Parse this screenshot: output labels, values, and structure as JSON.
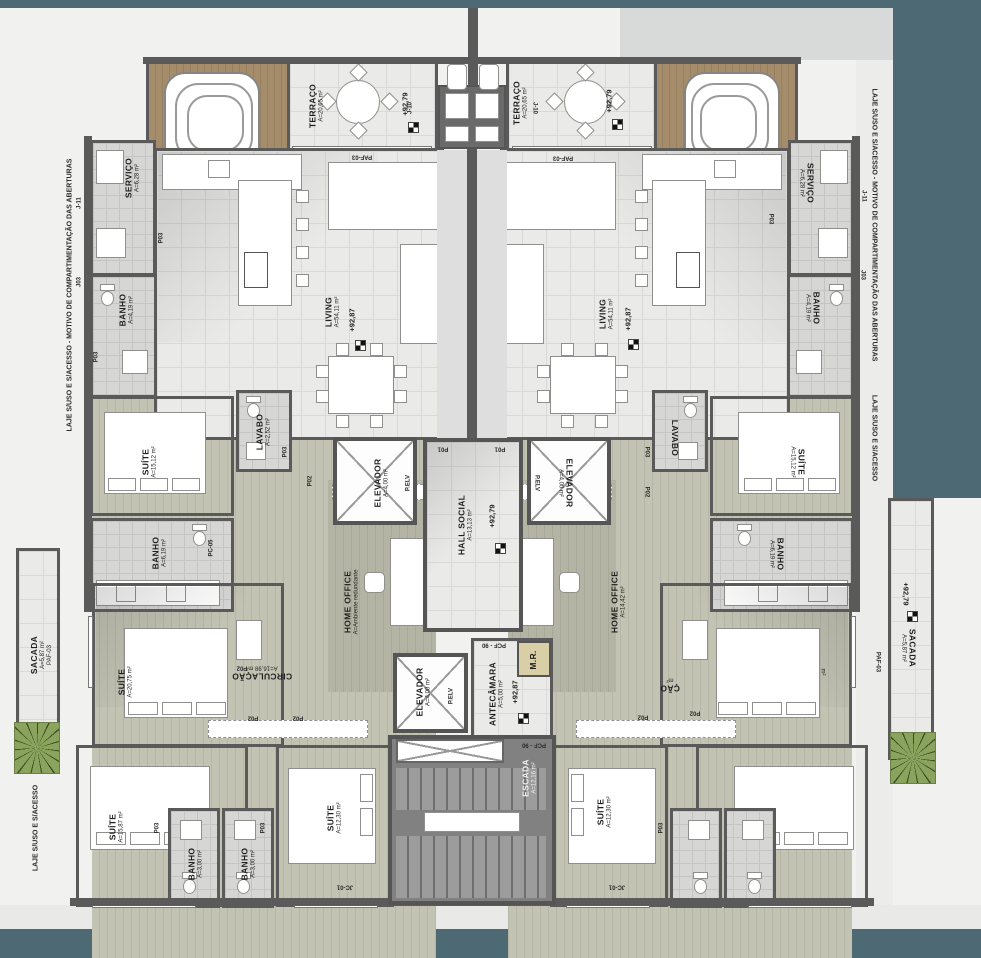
{
  "title": "Floor plan - residential apartments",
  "edge_notes": {
    "left_full": "LAJE S/USO E S/ACESSO - MOTIVO DE COMPARTIMENTAÇÃO DAS ABERTURAS",
    "right_full": "LAJE S/USO E S/ACESSO - MOTIVO DE COMPARTIMENTAÇÃO DAS ABERTURAS",
    "right_lower": "LAJE S/USO E S/ACESSO",
    "bottom_left": "LAJE S/USO E S/ACESSO"
  },
  "levels": {
    "p79": "+92,79",
    "p87": "+92,87"
  },
  "rooms": {
    "terraco": {
      "name": "TERRAÇO",
      "area": "A=20,65 m²"
    },
    "servico": {
      "name": "SERVIÇO",
      "area": "A=6,28 m²"
    },
    "banho_social": {
      "name": "BANHO",
      "area": "A=4,19 m²"
    },
    "living": {
      "name": "LIVING",
      "area": "A=54,11 m²"
    },
    "lavabo": {
      "name": "LAVABO",
      "area": "A=2,52 m²"
    },
    "suite1": {
      "name": "SUÍTE",
      "area": "A=15,12 m²"
    },
    "banho_suite": {
      "name": "BANHO",
      "area": "A=6,19 m²"
    },
    "sacada": {
      "name": "SACADA",
      "area": "A=5,87 m²"
    },
    "suite_master": {
      "name": "SUÍTE",
      "area": "A=20,75 m²"
    },
    "suite_master_right": {
      "area": "m²"
    },
    "circulacao": {
      "name": "CIRCULAÇÃO",
      "area": "A=16,98 m²"
    },
    "circulacao_right": {
      "name": "ÇÃO",
      "area": "m²"
    },
    "home_office_left": {
      "name": "HOME OFFICE",
      "area": "A=Ambiente redundante"
    },
    "home_office_right": {
      "name": "HOME OFFICE",
      "area": "A=14,42 m²"
    },
    "suite2": {
      "name": "SUÍTE",
      "area": "A=15,87 m²"
    },
    "banho_small": {
      "name": "BANHO",
      "area": "A=3,00 m²"
    },
    "suite3": {
      "name": "SUÍTE",
      "area": "A=12,30 m²"
    },
    "elevador": {
      "name": "ELEVADOR",
      "area": "A=4,00 m²"
    },
    "hall": {
      "name": "HALL SOCIAL",
      "area": "A=13,13 m²"
    },
    "antecamara": {
      "name": "ANTECÂMARA",
      "area": "A=5,00 m²"
    },
    "mr": {
      "name": "M.R."
    },
    "escada": {
      "name": "ESCADA",
      "area": "A=12,16 m²"
    }
  },
  "tags": {
    "j11": "J-11",
    "j03": "J03",
    "j10": "J-10",
    "jc01": "JC-01",
    "p01": "P01",
    "p02": "P02",
    "p03": "P03",
    "pc05": "PC-05",
    "paf03": "PAF-03",
    "pcf90": "PCF - 90",
    "pelv": "P.ELV"
  },
  "colors": {
    "teal_border": "#4d6973",
    "wall": "#5a5a5a",
    "wood_deck": "#a58c6b",
    "tile_floor": "#eaeae8",
    "plank_floor": "#c3c3b4",
    "mr_room": "#d8cfa6",
    "stair": "#818181",
    "plant": "#8aa45e"
  }
}
